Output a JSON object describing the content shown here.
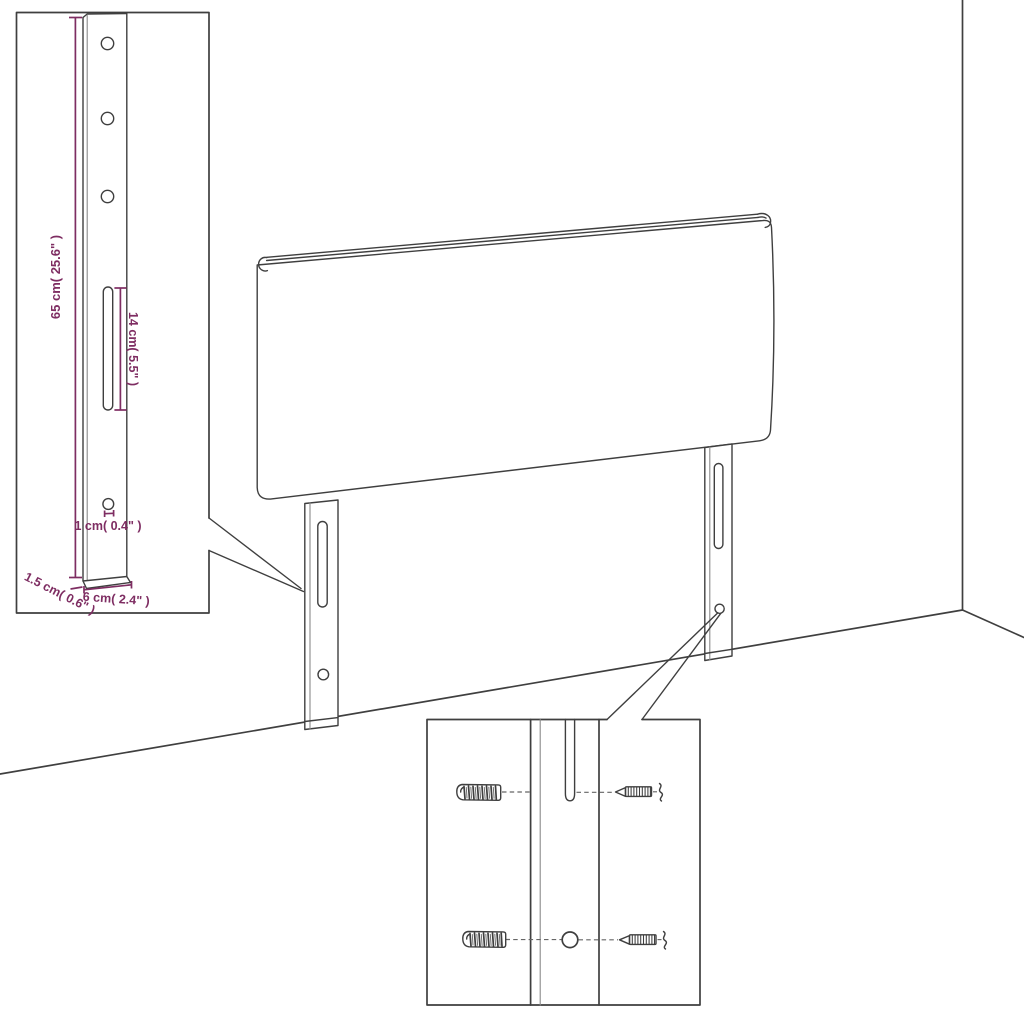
{
  "colors": {
    "line": "#3f3f3f",
    "line_soft": "#8a8a8a",
    "dimension": "#7e2d62",
    "background": "#ffffff"
  },
  "bracket_inset": {
    "dim_height": "65 cm( 25.6\" )",
    "dim_slot_length": "14 cm( 5.5\" )",
    "dim_hole": "1 cm( 0.4\" )",
    "dim_thickness": "1.5 cm( 0.6\" )",
    "dim_width": "6 cm( 2.4\" )"
  }
}
